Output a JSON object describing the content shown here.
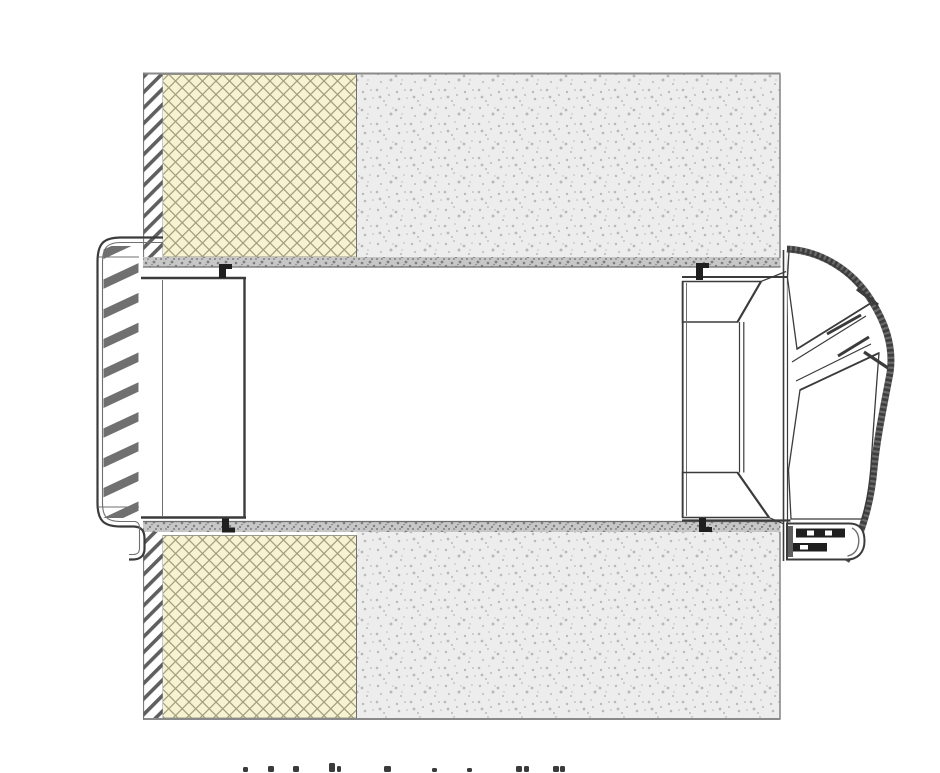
{
  "drawing": {
    "kind": "door-frame-horizontal-section-detail",
    "theme": {
      "background": "#ffffff",
      "line_dark": "#3b3b3b",
      "line_mid": "#6f6f6f",
      "wall_edge_gray": "#8a8a8a",
      "concrete_fill": "#ededed",
      "concrete_dot": "#b9b9b9",
      "face_band_fill": "#c7c7c7",
      "face_band_dot": "#7e7e7e",
      "insulation_fill": "#f6f3d2",
      "insulation_hatch": "#a59f7d",
      "steel_hatch": "#5f5f5f",
      "profile_stripe": "#707070",
      "honeycomb_line": "#4f4f4f",
      "hinge_dark": "#1f1f1f"
    },
    "caption": {
      "note": "caption text cropped at image bottom; only letter tops visible",
      "y_bottom": 772,
      "marks": [
        {
          "x": 243,
          "w": 5,
          "h": 5
        },
        {
          "x": 268,
          "w": 6,
          "h": 6
        },
        {
          "x": 293,
          "w": 6,
          "h": 6
        },
        {
          "x": 329,
          "w": 6,
          "h": 9
        },
        {
          "x": 337,
          "w": 4,
          "h": 6
        },
        {
          "x": 384,
          "w": 7,
          "h": 6
        },
        {
          "x": 432,
          "w": 5,
          "h": 4
        },
        {
          "x": 467,
          "w": 5,
          "h": 4
        },
        {
          "x": 516,
          "w": 6,
          "h": 6
        },
        {
          "x": 524,
          "w": 5,
          "h": 6
        },
        {
          "x": 553,
          "w": 6,
          "h": 6
        },
        {
          "x": 560,
          "w": 5,
          "h": 6
        }
      ]
    }
  }
}
